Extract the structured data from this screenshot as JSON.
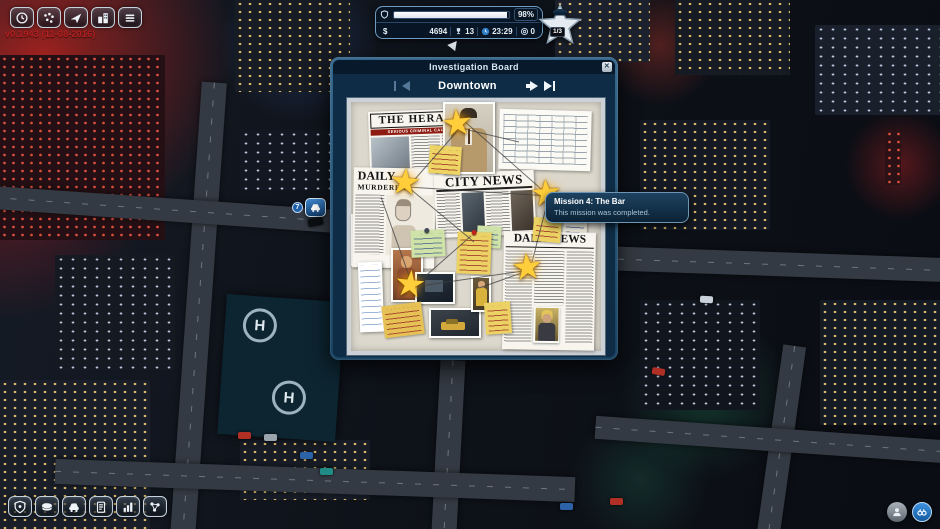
{
  "version_text": "v0.1943 (11-08-2016)",
  "top_toolbar": {
    "buttons": [
      {
        "icon": "clock-icon"
      },
      {
        "icon": "crime-map-icon"
      },
      {
        "icon": "navigation-arrow-icon"
      },
      {
        "icon": "city-hall-icon"
      },
      {
        "icon": "task-list-icon"
      }
    ]
  },
  "hud": {
    "progress_percent": "98%",
    "progress_value": 98,
    "currency_symbol": "$",
    "money": "4694",
    "trophies": "13",
    "time": "23:29",
    "coins": "0",
    "star_progress": "1/3"
  },
  "map_marker": {
    "badge": "7"
  },
  "dialog": {
    "title": "Investigation Board",
    "close_label": "✕",
    "location": "Downtown"
  },
  "board": {
    "clippings": {
      "herald": {
        "masthead": "THE HERALD",
        "banner": "SERIOUS CRIMINAL CAUGHT"
      },
      "daily": {
        "masthead": "DAILY",
        "headline": "MURDERER"
      },
      "city_news": {
        "masthead": "CITY NEWS"
      },
      "daily_news": {
        "masthead": "DAILY NEWS"
      }
    },
    "star_count": 5
  },
  "tooltip": {
    "title": "Mission 4: The Bar",
    "body": "This mission was completed."
  },
  "bottom_toolbar": {
    "buttons": [
      {
        "icon": "police-badge-icon"
      },
      {
        "icon": "police-cap-icon"
      },
      {
        "icon": "patrol-car-icon"
      },
      {
        "icon": "reports-icon"
      },
      {
        "icon": "statistics-icon"
      },
      {
        "icon": "network-icon"
      }
    ]
  },
  "corner_buttons": [
    {
      "icon": "person-icon"
    },
    {
      "icon": "binoculars-icon"
    }
  ],
  "helipad_label": "H",
  "colors": {
    "accent_blue": "#2f78c0",
    "dialog_frame": "#2e6489",
    "gold_star": "#ffce3a",
    "alert_red": "#8e1b12",
    "version_red": "#b61f1f"
  }
}
